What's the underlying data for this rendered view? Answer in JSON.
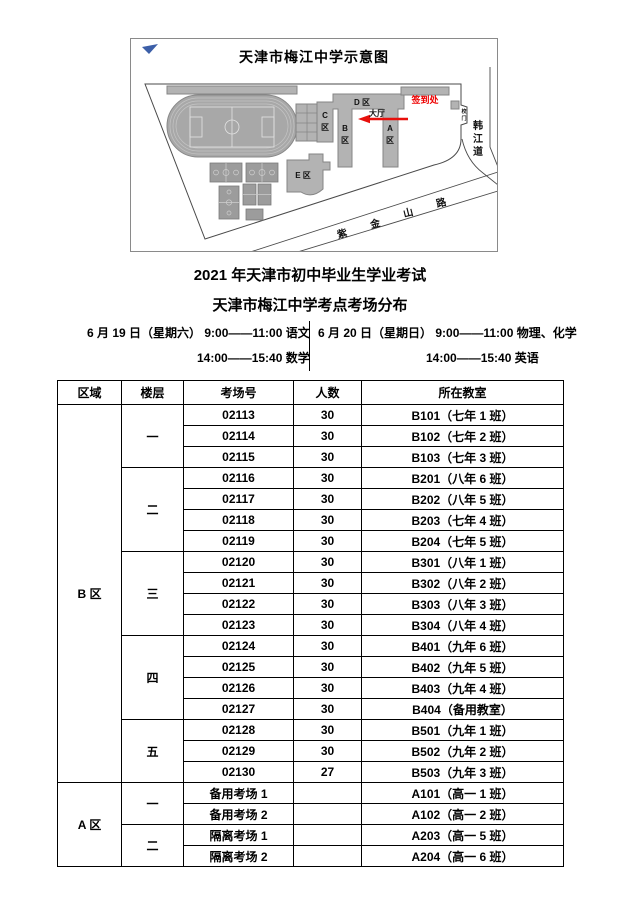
{
  "map": {
    "title": "天津市梅江中学示意图",
    "labels": {
      "zone_d": "D 区",
      "zone_c_1": "C",
      "zone_c_2": "区",
      "zone_b_1": "B",
      "zone_b_2": "区",
      "zone_a_1": "A",
      "zone_a_2": "区",
      "zone_e": "E 区",
      "hall": "大厅",
      "checkin": "签到处",
      "gate_1": "校",
      "gate_2": "门",
      "road_south": [
        "紫",
        "金",
        "山",
        "路"
      ],
      "road_east": [
        "韩",
        "江",
        "道"
      ]
    },
    "colors": {
      "building": "#b3b3b3",
      "checkin_red": "#ee0000",
      "arrow_red": "#e8100c",
      "flag_blue": "#3c5fa8"
    }
  },
  "heading": {
    "title1": "2021 年天津市初中毕业生学业考试",
    "title2": "天津市梅江中学考点考场分布"
  },
  "schedule": {
    "left": {
      "line1": "6 月 19 日（星期六）  9:00——11:00 语文",
      "line2": "14:00——15:40 数学"
    },
    "right": {
      "line1": "6 月 20 日（星期日）  9:00——11:00 物理、化学",
      "line2": "14:00——15:40 英语"
    }
  },
  "table": {
    "headers": [
      "区域",
      "楼层",
      "考场号",
      "人数",
      "所在教室"
    ],
    "sections": [
      {
        "region": "B 区",
        "floors": [
          {
            "floor": "一",
            "rows": [
              [
                "02113",
                "30",
                "B101（七年 1 班）"
              ],
              [
                "02114",
                "30",
                "B102（七年 2 班）"
              ],
              [
                "02115",
                "30",
                "B103（七年 3 班）"
              ]
            ]
          },
          {
            "floor": "二",
            "rows": [
              [
                "02116",
                "30",
                "B201（八年 6 班）"
              ],
              [
                "02117",
                "30",
                "B202（八年 5 班）"
              ],
              [
                "02118",
                "30",
                "B203（七年 4 班）"
              ],
              [
                "02119",
                "30",
                "B204（七年 5 班）"
              ]
            ]
          },
          {
            "floor": "三",
            "rows": [
              [
                "02120",
                "30",
                "B301（八年 1 班）"
              ],
              [
                "02121",
                "30",
                "B302（八年 2 班）"
              ],
              [
                "02122",
                "30",
                "B303（八年 3 班）"
              ],
              [
                "02123",
                "30",
                "B304（八年 4 班）"
              ]
            ]
          },
          {
            "floor": "四",
            "rows": [
              [
                "02124",
                "30",
                "B401（九年 6 班）"
              ],
              [
                "02125",
                "30",
                "B402（九年 5 班）"
              ],
              [
                "02126",
                "30",
                "B403（九年 4 班）"
              ],
              [
                "02127",
                "30",
                "B404（备用教室）"
              ]
            ]
          },
          {
            "floor": "五",
            "rows": [
              [
                "02128",
                "30",
                "B501（九年 1 班）"
              ],
              [
                "02129",
                "30",
                "B502（九年 2 班）"
              ],
              [
                "02130",
                "27",
                "B503（九年 3 班）"
              ]
            ]
          }
        ]
      },
      {
        "region": "A 区",
        "floors": [
          {
            "floor": "一",
            "rows": [
              [
                "备用考场 1",
                "",
                "A101（高一 1 班）"
              ],
              [
                "备用考场 2",
                "",
                "A102（高一 2 班）"
              ]
            ]
          },
          {
            "floor": "二",
            "rows": [
              [
                "隔离考场 1",
                "",
                "A203（高一 5 班）"
              ],
              [
                "隔离考场 2",
                "",
                "A204（高一 6 班）"
              ]
            ]
          }
        ]
      }
    ]
  }
}
